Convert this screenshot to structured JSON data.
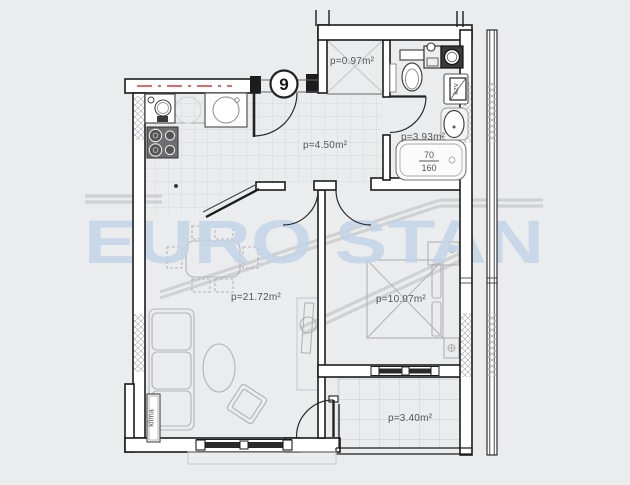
{
  "watermark": {
    "text": "EURO STAN"
  },
  "apartment": {
    "unit_number": "9"
  },
  "rooms": {
    "closet": {
      "area_label": "p=0.97m²"
    },
    "hallway": {
      "area_label": "p=4.50m²"
    },
    "bathroom": {
      "area_label": "p=3.93m²"
    },
    "living_room": {
      "area_label": "p=21.72m²"
    },
    "bedroom": {
      "area_label": "p=10.07m²"
    },
    "balcony": {
      "area_label": "p=3.40m²"
    }
  },
  "equipment": {
    "air_conditioner_label": "klima",
    "boiler_label": "kzv",
    "bathtub": {
      "width_cm": "70",
      "length_cm": "160"
    }
  },
  "colors": {
    "watermark_blue": "#c2d5e8",
    "accent_red": "#e2696b",
    "background": "#ebecee",
    "wall_black": "#1c1c1c"
  }
}
